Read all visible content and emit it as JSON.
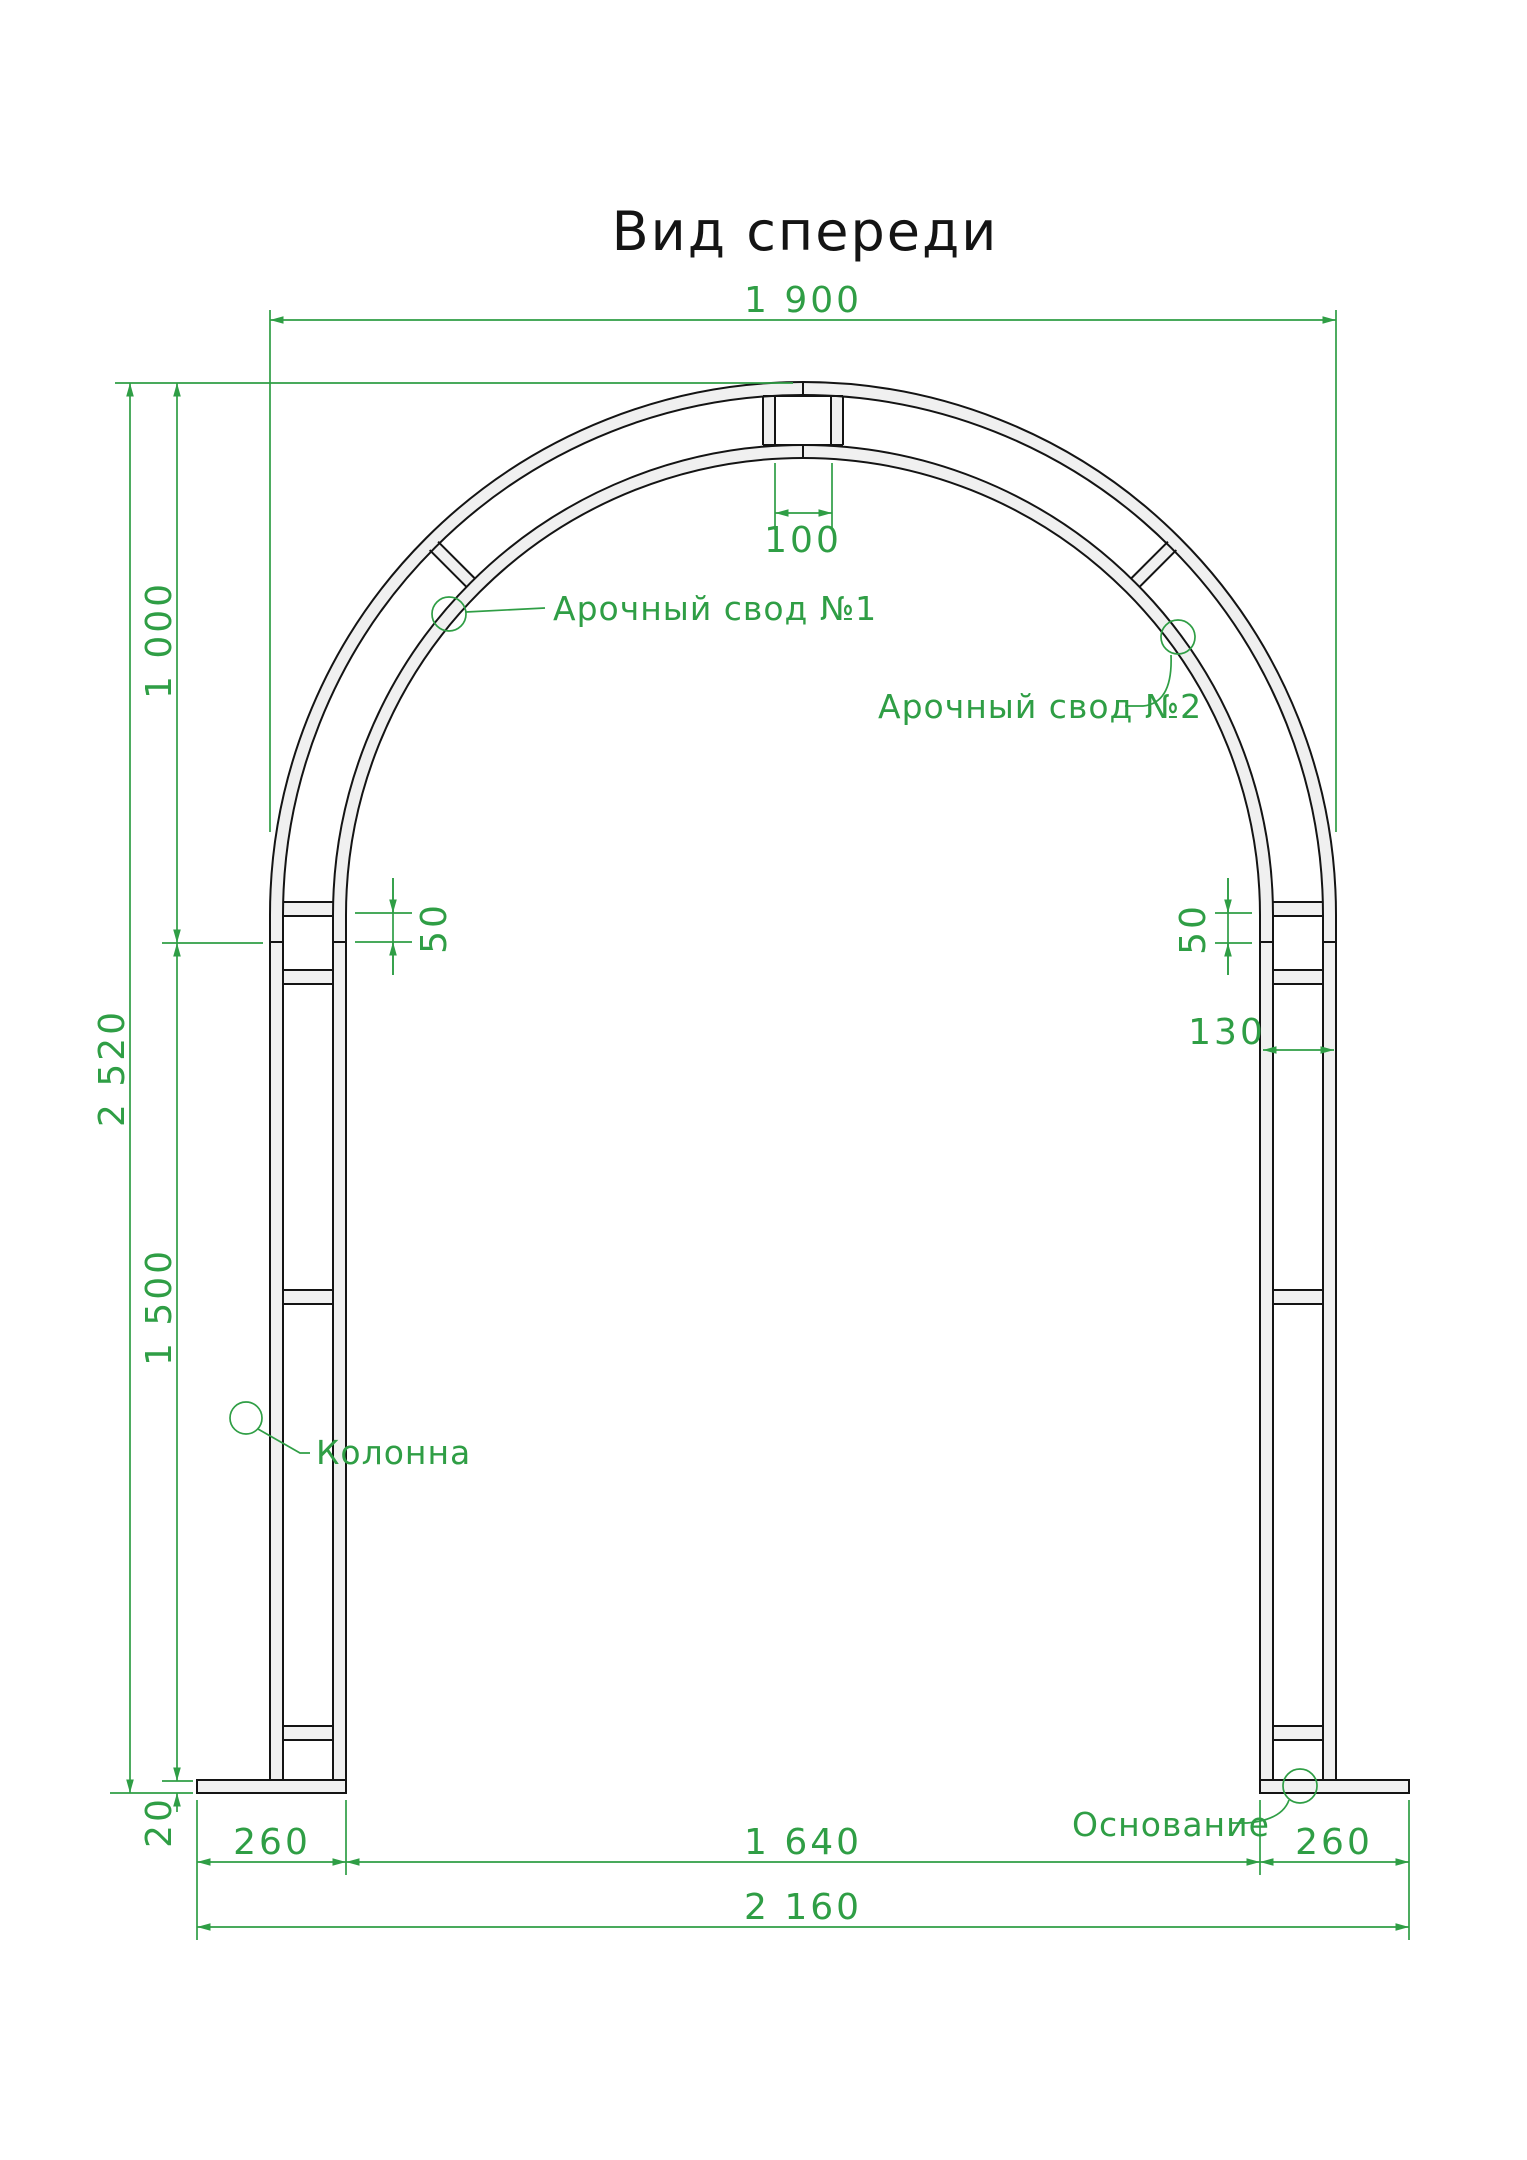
{
  "title": "Вид спереди",
  "colors": {
    "dimension_green": "#2f9e45",
    "line_black": "#141414",
    "tube_fill": "#f0f0f0"
  },
  "dims": {
    "arch_outer_width": "1 900",
    "apex_opening": "100",
    "arch_height": "1 000",
    "total_height": "2 520",
    "column_height": "1 500",
    "base_plate_thickness": "20",
    "joint_offset_left": "50",
    "joint_offset_right": "50",
    "column_width": "130",
    "base_left_width": "260",
    "clear_span": "1 640",
    "base_right_width": "260",
    "overall_width": "2 160"
  },
  "labels": {
    "vault_1": "Арочный свод №1",
    "vault_2": "Арочный свод №2",
    "column": "Колонна",
    "base": "Основание"
  }
}
